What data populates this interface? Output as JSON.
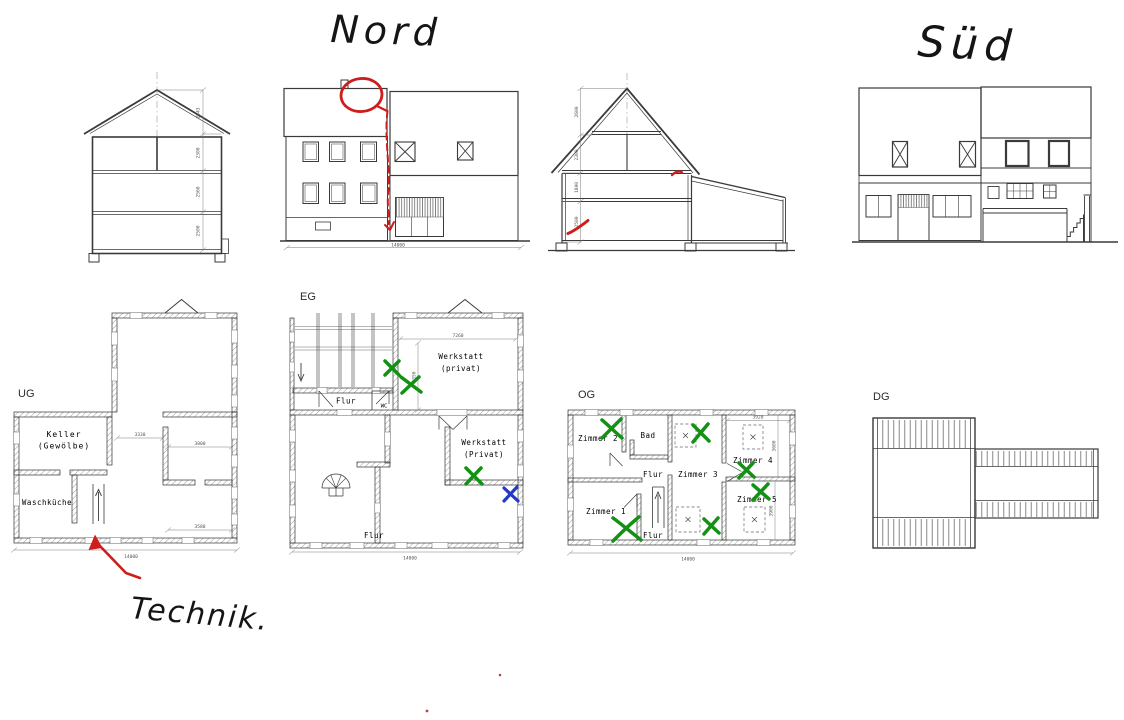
{
  "colors": {
    "annotation_red": "#cf1d1d",
    "approval_green": "#149114",
    "mark_blue": "#2438c8",
    "drawing_line": "#3a3a3a"
  },
  "handwriting": {
    "north": "Nord",
    "south": "Süd",
    "technik": "Technik."
  },
  "sections": {
    "west": {
      "dims": [
        "2543",
        "2300",
        "2560",
        "2500"
      ]
    },
    "mid": {
      "dims": [
        "2600",
        "2300",
        "1800",
        "2500"
      ]
    }
  },
  "elevations": {
    "north": {
      "width_dim": "14000"
    }
  },
  "plans": {
    "ug": {
      "label": "UG",
      "room_keller_line1": "Keller",
      "room_keller_line2": "(Gewölbe)",
      "room_waschkueche": "Waschküche",
      "dim_a": "3330",
      "dim_b": "3800",
      "dim_c": "3580",
      "dim_total": "14000"
    },
    "eg": {
      "label": "EG",
      "werkstatt_top_line1": "Werkstatt",
      "werkstatt_top_line2": "(privat)",
      "werkstatt_low_line1": "Werkstatt",
      "werkstatt_low_line2": "(Privat)",
      "flur_top": "Flur",
      "wc": "WC",
      "flur_bottom": "Flur",
      "dim_width": "7260",
      "dim_height": "5350",
      "dim_total": "14000"
    },
    "og": {
      "label": "OG",
      "zimmer1": "Zimmer 1",
      "zimmer2": "Zimmer 2",
      "zimmer3": "Zimmer 3",
      "zimmer4": "Zimmer 4",
      "zimmer5": "Zimmer 5",
      "bad": "Bad",
      "flur_mid": "Flur",
      "flur_bottom": "Flur",
      "dim_a": "3920",
      "dim_b": "3600",
      "dim_c": "3900",
      "dim_total": "14000"
    },
    "dg": {
      "label": "DG"
    }
  }
}
